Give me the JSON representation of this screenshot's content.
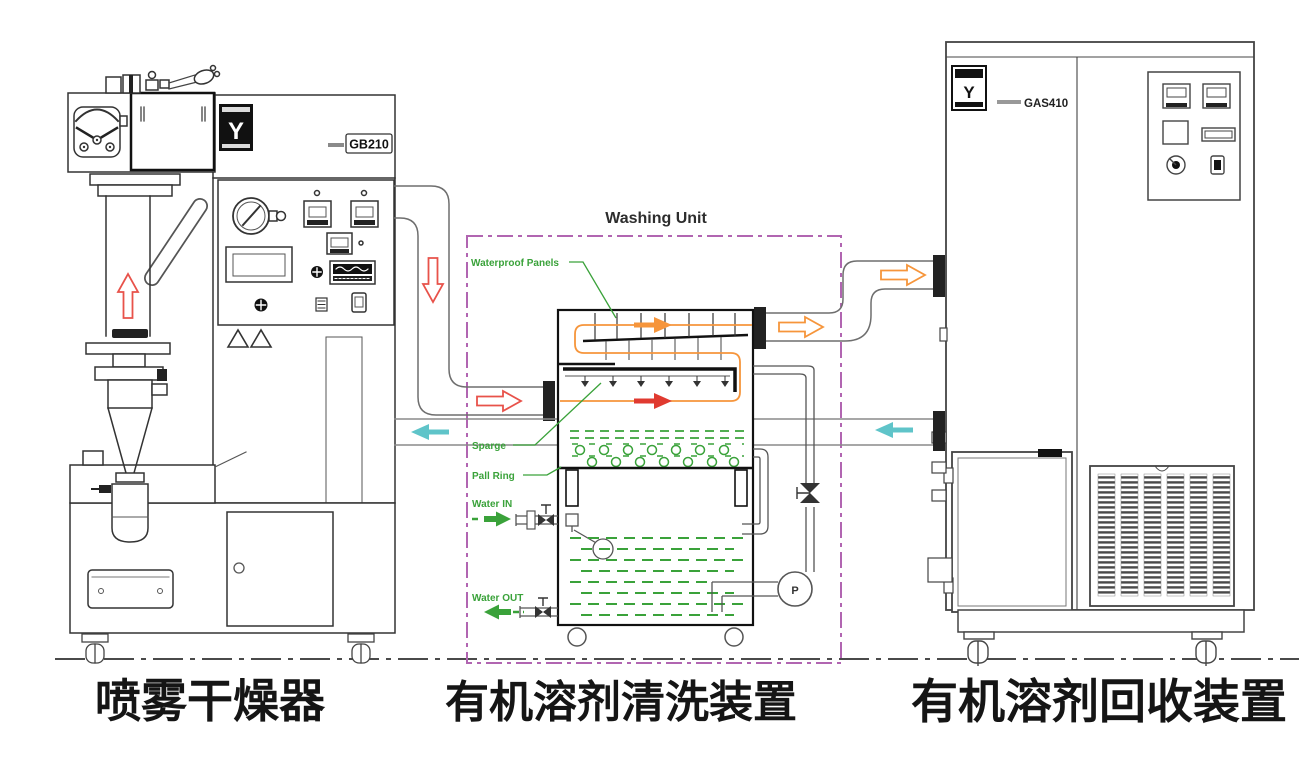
{
  "figure": {
    "washing_unit_title": "Washing Unit",
    "captions": {
      "spray_dryer": "喷雾干燥器",
      "washing": "有机溶剂清洗装置",
      "recovery": "有机溶剂回收装置"
    },
    "models": {
      "spray_dryer": "GB210",
      "recovery": "GAS410"
    },
    "brand_letter": "Y",
    "washing_labels": {
      "waterproof_panels": "Waterproof Panels",
      "sparge": "Sparge",
      "pall_ring": "Pall Ring",
      "water_in": "Water IN",
      "water_out": "Water OUT"
    },
    "pump_label": "P",
    "colors": {
      "label_green": "#3aa23a",
      "boundary_purple": "#b165b1",
      "flow_orange": "#f6953b",
      "flow_red": "#e8524a",
      "return_cyan": "#5fc4c9",
      "line_dark": "#333333"
    }
  }
}
